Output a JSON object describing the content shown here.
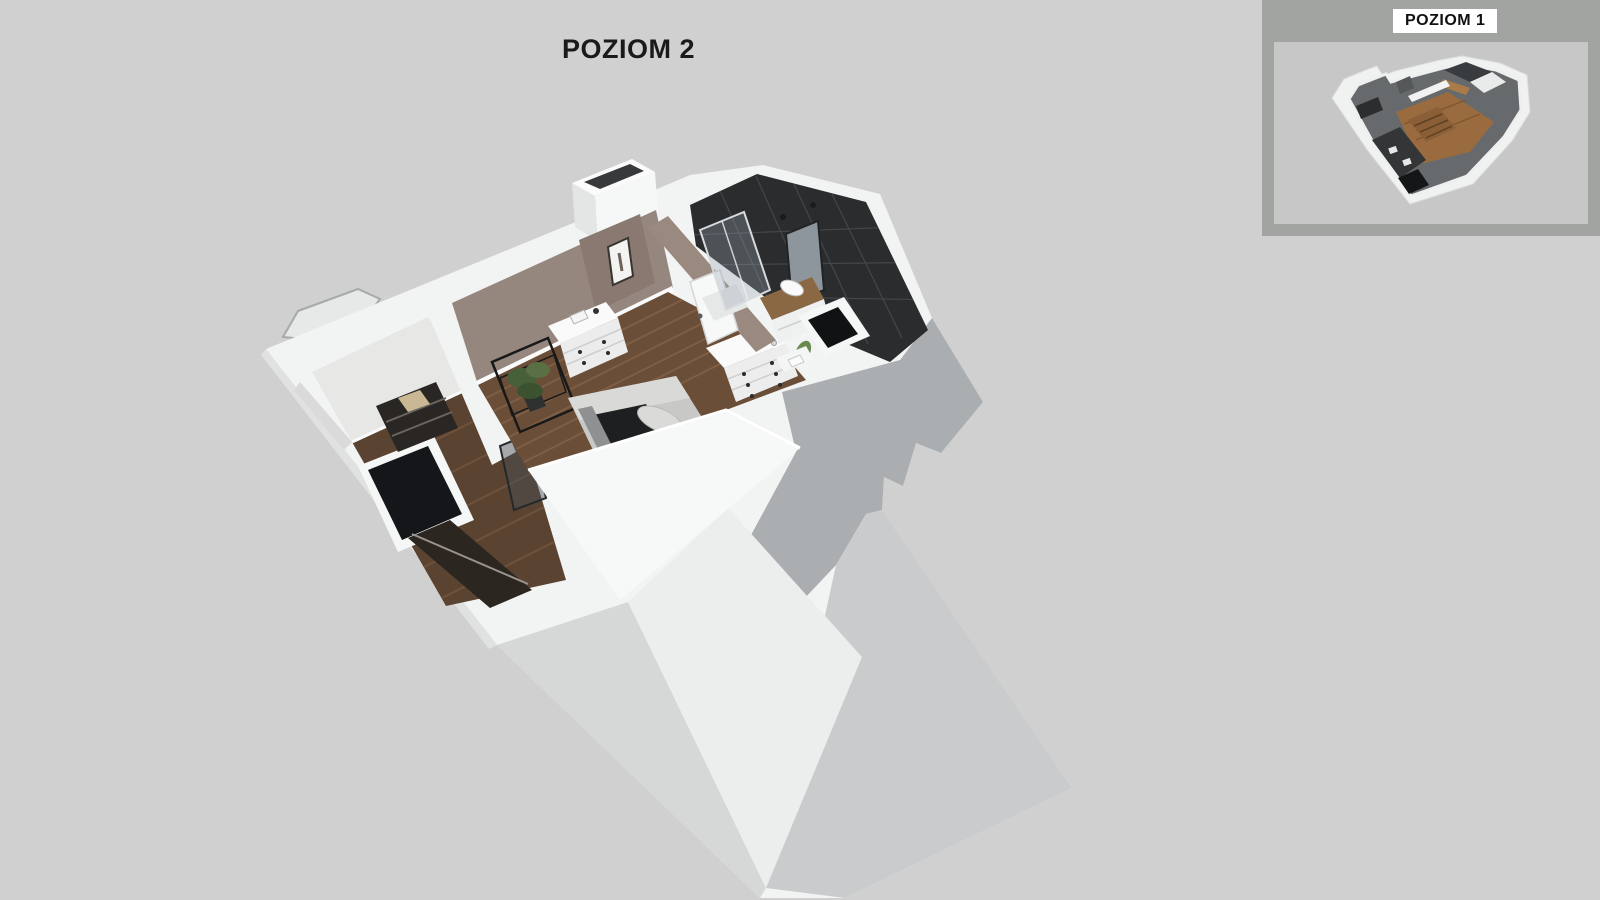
{
  "page": {
    "background_color": "#cfd0cf"
  },
  "main_view": {
    "title": "POZIOM 2",
    "title_color": "#1a1a1a",
    "content": "3d-cutaway-floorplan-level-2"
  },
  "inset": {
    "title": "POZIOM 1",
    "frame_color": "#a2a4a2",
    "inner_background": "#c6c7c6",
    "label_background": "#ffffff",
    "label_color": "#111111",
    "content": "3d-cutaway-floorplan-level-1"
  },
  "palette": {
    "wall_white": "#f2f3f3",
    "wall_bright": "#f7f8f8",
    "roof_shadow_gray": "#abaeb1",
    "roof_pale_gray": "#c9cbcd",
    "dormer_face": "#eceeee",
    "taupe_wall": "#96877e",
    "wood_floor": "#6b4e38",
    "wood_floor_dark": "#5a4331",
    "bathroom_tile": "#2b2c2e",
    "stair_opening": "#141619",
    "plant_green": "#50693e"
  }
}
